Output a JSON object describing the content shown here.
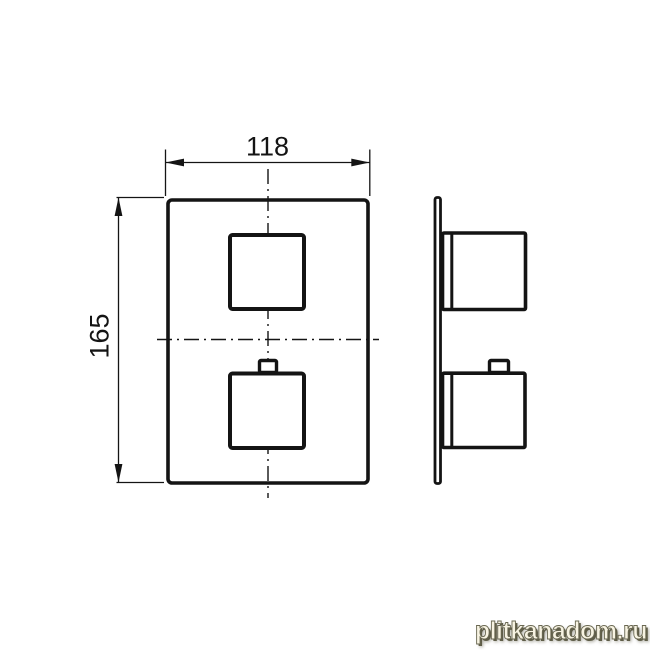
{
  "page": {
    "background_color": "#ffffff",
    "description": "Technical dimension drawing of a square concealed thermostatic shower mixer trim: front view with two square handles and side profile view on a thin wall plate"
  },
  "drawing": {
    "line_color": "#141414",
    "views": {
      "front_view": "faceplate-with-two-square-knobs",
      "side_view": "profile-with-wall-plate-and-knobs"
    },
    "dimensions": {
      "width": {
        "label": "118"
      },
      "height": {
        "label": "165"
      }
    }
  },
  "watermark": {
    "text": "plitkanadom.ru",
    "fill_color": "#f7f3e2",
    "shadow_color": "#5f5d48"
  }
}
